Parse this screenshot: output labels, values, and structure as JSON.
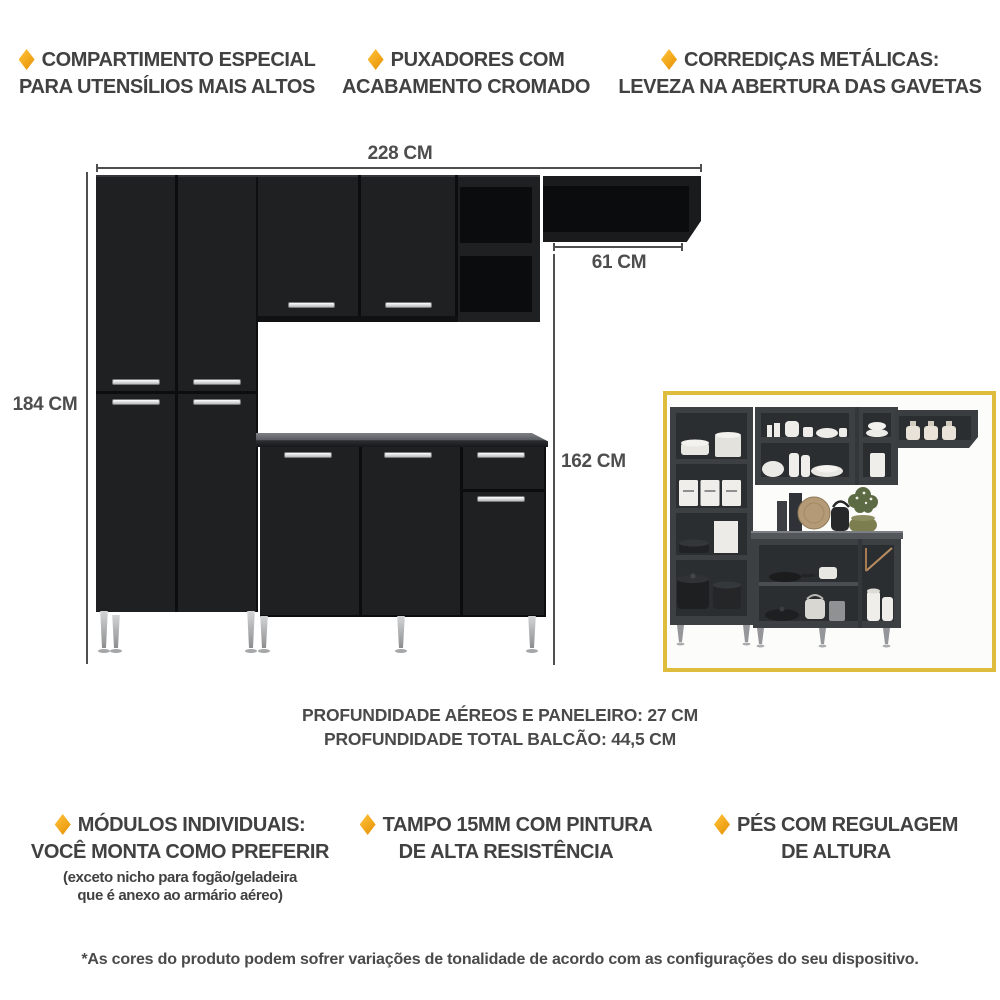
{
  "features_top": [
    {
      "lines": [
        "COMPARTIMENTO ESPECIAL",
        "PARA UTENSÍLIOS MAIS ALTOS"
      ]
    },
    {
      "lines": [
        "PUXADORES COM",
        "ACABAMENTO CROMADO"
      ]
    },
    {
      "lines": [
        "CORREDIÇAS METÁLICAS:",
        "LEVEZA NA ABERTURA DAS GAVETAS"
      ]
    }
  ],
  "dimensions": {
    "total_width": "228 CM",
    "corner_shelf_width": "61 CM",
    "paneleiro_height": "184 CM",
    "balcao_height": "162 CM"
  },
  "depth_notes": [
    "PROFUNDIDADE AÉREOS E PANELEIRO: 27 CM",
    "PROFUNDIDADE TOTAL BALCÃO: 44,5 CM"
  ],
  "features_bottom": [
    {
      "lines": [
        "MÓDULOS INDIVIDUAIS:",
        "VOCÊ MONTA COMO PREFERIR"
      ],
      "note": [
        "(exceto nicho para fogão/geladeira",
        "que é anexo ao armário aéreo)"
      ]
    },
    {
      "lines": [
        "TAMPO 15MM COM PINTURA",
        "DE ALTA RESISTÊNCIA"
      ]
    },
    {
      "lines": [
        "PÉS COM REGULAGEM",
        "DE ALTURA"
      ]
    }
  ],
  "disclaimer": "*As cores do produto podem sofrer variações de tonalidade de acordo com as configurações do seu dispositivo.",
  "icons": {
    "bullet": "diamond"
  },
  "colors": {
    "accent": "#F2A71B",
    "cabinet_black": "#1E2022",
    "dim_line": "#4F4F4F",
    "text_gray": "#414141",
    "inset_border": "#DEBD3E",
    "countertop_gray": "#63676B",
    "chrome": "#E9EAEB"
  }
}
